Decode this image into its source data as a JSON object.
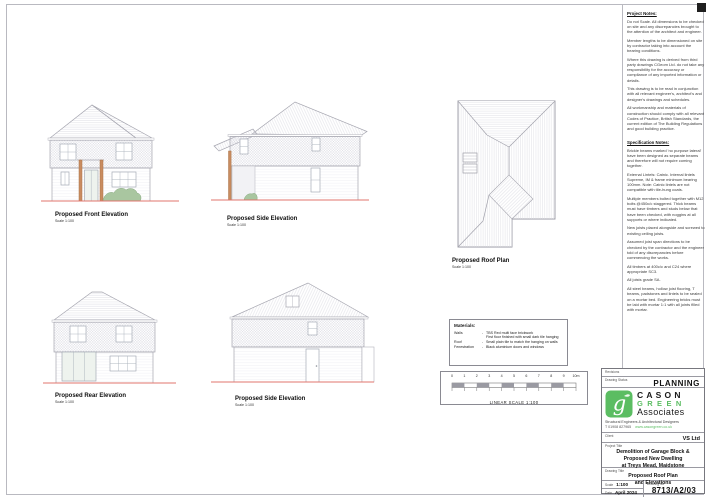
{
  "drawings": {
    "front": {
      "title": "Proposed Front Elevation",
      "scale": "Scale 1:100"
    },
    "side1": {
      "title": "Proposed Side Elevation",
      "scale": "Scale 1:100"
    },
    "roof": {
      "title": "Proposed Roof Plan",
      "scale": "Scale 1:100"
    },
    "rear": {
      "title": "Proposed Rear Elevation",
      "scale": "Scale 1:100"
    },
    "side2": {
      "title": "Proposed Side Elevation",
      "scale": "Scale 1:100"
    }
  },
  "materials": {
    "heading": "Materials:",
    "rows": [
      {
        "item": "Walls",
        "dash": "-",
        "lines": [
          "TBS Red multi face brickwork",
          "First floor finished with small dark tile hanging"
        ]
      },
      {
        "item": "Roof",
        "dash": "-",
        "lines": [
          "Small plain tile to match the hanging on walls"
        ]
      },
      {
        "item": "Fenestration",
        "dash": "-",
        "lines": [
          "Black aluminium doors and windows"
        ]
      }
    ]
  },
  "linear_scale": {
    "ticks": [
      "0",
      "1",
      "2",
      "3",
      "4",
      "5",
      "6",
      "7",
      "8",
      "9",
      "10m"
    ],
    "caption": "LINEAR SCALE 1:100"
  },
  "notes": {
    "project_heading": "Project Notes:",
    "project": [
      "Do not Scale. All dimensions to be checked on site and any discrepancies brought to the attention of the architect and engineer.",
      "Member lengths to be dimensioned on site by contractor taking into account the bearing conditions.",
      "Where this drawing is derived from third party drawings CGeom Ltd. do not take any responsibility for the accuracy or compliance of any imported information or details.",
      "This drawing is to be read in conjunction with all relevant engineer's, architect's and designer's drawings and schedules.",
      "All workmanship and materials of construction should comply with all relevant Codes of Practice, British Standards, the current edition of The Building Regulations and good building practice."
    ],
    "spec_heading": "Specification Notes:",
    "spec": [
      "Brickie beams marked 'no purpose lateral' have been designed as separate beams and therefore will not require coming together.",
      "External Lintels: Catnic. Internal lintels Supreme, IM & frame minimum bearing 100mm. Note: Catnic lintels are not compatible with tile-hung coats.",
      "Multiple members bolted together with M12 bolts @450c/c staggered. Thick beams must have timbers and studs below that have been checked, with noggins at all supports or where indicated.",
      "New joists placed alongside and screwed to existing ceiling joists.",
      "Assumed joist span directions to be checked by the contractor and the engineer told of any discrepancies before commencing the works.",
      "All timbers at 400c/c and C24 where appropriate SC3.",
      "All joists grade SA.",
      "All steel beams, hollow joist flooring, T beams, padstones and lintels to be sealed on a mortar bed. Engineering bricks must be laid with mortar 1:1 with all joints filled with mortar."
    ]
  },
  "titleblock": {
    "revisions_label": "Revisions",
    "status_label": "Drawing Status",
    "status_value": "PLANNING",
    "logo": {
      "word1": "CASON",
      "word2": "GREEN",
      "word3": "Associates",
      "tagline": "Structural Engineers & Architectural Designers",
      "phone": "T 01908 827965",
      "website": "www.casongreen.co.uk"
    },
    "client_label": "Client",
    "client_value": "VS Ltd",
    "project_label": "Project Title",
    "project_lines": [
      "Demolition of Garage Block &",
      "Proposed New Dwelling",
      "at Treys Mead, Maidstone"
    ],
    "drawing_label": "Drawing Title",
    "drawing_lines": [
      "Proposed Roof Plan",
      "and Elevations"
    ],
    "scale_label": "Scale",
    "scale_value": "1:100",
    "date_label": "Date",
    "date_value": "April 2024",
    "number_label": "Drawing No",
    "number_value": "8713/A2/03"
  },
  "colors": {
    "logo_green": "#5bbd62",
    "ground_line_red": "#e0746c",
    "oak_post_orange": "#c98c60",
    "shrub_green": "#a9c6a0",
    "line_gray": "#a6a6b0"
  }
}
